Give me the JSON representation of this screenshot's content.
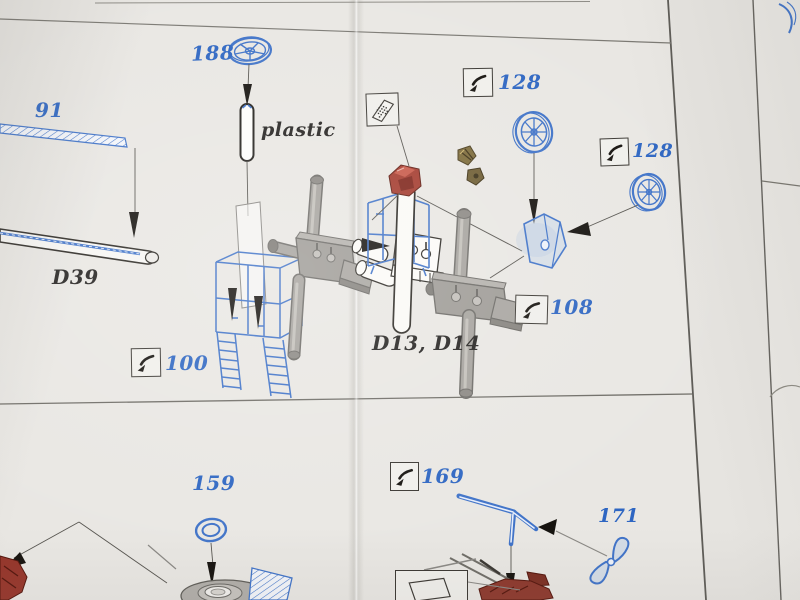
{
  "document": {
    "kind": "photo-etch model kit assembly instructions, scanned page detail",
    "background": "#e9e7e3"
  },
  "labels": {
    "part_188": "188",
    "part_91": "91",
    "note_plastic": "plastic",
    "part_d39": "D39",
    "part_128_top": "128",
    "part_128_right": "128",
    "part_108": "108",
    "part_100": "100",
    "part_d13_d14": "D13, D14",
    "part_159": "159",
    "part_169": "169",
    "part_171": "171"
  },
  "icons": {
    "bend_arrow_icon": "curved bend arrow symbol",
    "pe_fret_icon": "photo-etch sheet symbol",
    "flat_sheet_icon": "flat sheet outline symbol"
  },
  "colors": {
    "paper": "#e9e7e3",
    "callout_blue": "#2e66c2",
    "drawing_blue": "#4073c8",
    "label_black": "#242220",
    "resin_red": "#a33a2d",
    "brass": "#7d6b3a",
    "plastic_gray": "#a6a39e"
  }
}
